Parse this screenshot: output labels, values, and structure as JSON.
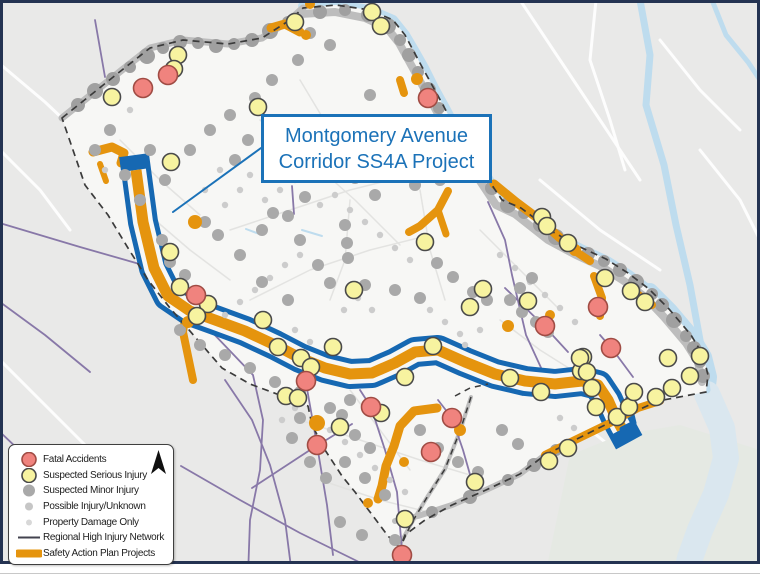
{
  "callout": {
    "line1": "Montgomery Avenue",
    "line2": "Corridor SS4A Project"
  },
  "legend": {
    "items": [
      {
        "label": "Fatal Accidents",
        "type": "circle",
        "fill": "#f0837e",
        "stroke": "#a04c44",
        "r": 7
      },
      {
        "label": "Suspected Serious Injury",
        "type": "circle",
        "fill": "#f7f3a0",
        "stroke": "#4a4a4a",
        "r": 7
      },
      {
        "label": "Suspected Minor Injury",
        "type": "circle",
        "fill": "#a9a9a9",
        "stroke": "none",
        "r": 6
      },
      {
        "label": "Possible Injury/Unknown",
        "type": "circle",
        "fill": "#c6c6c6",
        "stroke": "none",
        "r": 4
      },
      {
        "label": "Property Damage Only",
        "type": "circle",
        "fill": "#d8d8d8",
        "stroke": "none",
        "r": 3
      },
      {
        "label": "Regional High Injury Network",
        "type": "line",
        "stroke": "#43434f",
        "w": 2
      },
      {
        "label": "Safety Action Plan Projects",
        "type": "thick-line",
        "stroke": "#e5940e",
        "w": 8
      }
    ]
  },
  "colors": {
    "outer_border": "#243352",
    "bg_outside": "#e9e9e8",
    "bg_inside": "#f7f7f5",
    "river": "#bedcee",
    "river_mouth": "#dae7ef",
    "park": "#e5e9e3",
    "white_street": "#fdfdfd",
    "inner_street": "#e3e3e1",
    "gray_band": "#bdbdbd",
    "band_dot": "#a0a0a0",
    "gray_dot": "#a9a9a9",
    "small_dot": "#cccccc",
    "purple": "#8878a8",
    "orange": "#e5940e",
    "corridor_blue": "#1668b2",
    "boundary": "#3b3b3b",
    "callout_blue": "#1b72b8",
    "yellow_fill": "#f7f3a0",
    "yellow_stroke": "#4a4a4a",
    "red_fill": "#f0837e",
    "red_stroke": "#a04c44",
    "bottom_line": "#c8c8c8"
  },
  "map": {
    "study_area_path": "M62,118 L92,94 L122,70 L150,48 L183,40 L228,44 L262,38 L290,20 L303,8 L336,5 L370,10 L393,20 L405,35 L413,50 L421,65 L432,85 L443,105 L452,122 L462,140 L472,158 L483,172 L502,200 L521,208 L553,232 L580,247 L606,259 L628,273 L649,289 L669,309 L691,335 L703,355 L708,375 L706,392 L658,401 L605,425 L575,440 L545,455 L520,474 L486,490 L452,505 L425,520 L405,535 L400,548 L388,536 L370,512 L355,492 L342,476 L325,450 L312,425 L308,406 L285,397 L250,384 L222,368 L196,338 L170,308 L148,280 L128,248 L108,215 L85,185 Z",
    "boundary_extra": [
      "M471,397 L460,431 L445,469 L426,499 L411,524 L400,548",
      "M455,396 L470,388 L488,384"
    ],
    "park_path": "M570,455 L620,435 L680,425 L760,450 L760,576 L545,576 Z",
    "rivers": [
      {
        "d": "M303,6 L336,5 L370,10 L393,20 L405,35 L415,52 L424,68 L434,88 L445,108 L454,125 L464,143 L474,160 L485,174 L503,201 L522,210 L553,234 L581,249 L607,261 L629,275 L650,291 L670,311 L692,337 L704,357 L709,377 L707,394",
        "w": 10,
        "c": "river"
      },
      {
        "d": "M650,291 L670,311 L692,337 L704,357 L709,377 L707,394",
        "w": 16,
        "c": "river"
      },
      {
        "d": "M707,394 L722,428 L726,458 L716,494 L700,530 L690,558 L686,576",
        "w": 26,
        "c": "river_mouth"
      },
      {
        "d": "M640,0 L650,55 L646,105 L664,165 L676,225 L690,285 L700,340 L707,390",
        "w": 7,
        "c": "river"
      },
      {
        "d": "M712,0 L726,35 L748,62 L760,80",
        "w": 5,
        "c": "river"
      }
    ],
    "white_streets": [
      "M520,0 L560,60 L600,120 L640,180",
      "M596,0 L590,60 L610,120 L625,170",
      "M660,40 L700,90 L740,130",
      "M540,180 L600,230 L660,270",
      "M700,150 L740,200 L760,240",
      "M0,64 L45,102 L80,135",
      "M0,150 L40,190 L70,230",
      "M0,360 L60,420 L110,470",
      "M30,576 L80,520 L140,470",
      "M600,460 L650,500 L700,540",
      "M620,576 L660,520 L700,480",
      "M590,430 L640,470"
    ],
    "inner_streets": [
      "M260,120 L310,160 L355,200 L400,245",
      "M230,230 L290,210 L350,190 L410,175",
      "M250,300 L310,270 L370,250 L430,235",
      "M350,200 L345,260 L330,300",
      "M420,190 L430,250 L445,300",
      "M300,80 L330,130 L355,175",
      "M480,230 L520,270 L560,310",
      "M300,420 L360,440 L420,460 L480,478",
      "M320,480 L380,500 L440,515",
      "M350,390 L380,430 L410,470",
      "M500,320 L540,350 L575,372",
      "M155,220 L190,250 L230,280",
      "M120,140 L160,180 L200,215"
    ],
    "creeks": [
      "M302,230 L322,236",
      "M246,229 L262,235",
      "M352,120 L368,128"
    ],
    "gray_bands": [
      {
        "d": "M62,118 L92,94 L122,70 L150,48 L183,40 L228,44 L262,38 L290,20 L303,8",
        "w": 7
      },
      {
        "d": "M300,14 L335,12 L365,18 L387,28 L399,43 L415,72 L437,112 L456,145 L468,164 L478,178 L496,205 L515,214 L548,240 L576,255 L602,267 L624,281 L645,297 L664,317 L686,343 L698,362 L702,382",
        "w": 8
      },
      {
        "d": "M545,455 L520,474 L488,489 L452,505 L418,516 L395,521",
        "w": 6
      },
      {
        "d": "M471,397 L460,431 L445,469 L426,499 L411,524 L400,544",
        "w": 4
      }
    ],
    "purple_roads": [
      "M95,20 L105,77",
      "M292,186 L294,214",
      "M3,224 L80,247 L150,267 L210,330 L253,375 L263,420 L260,470 L250,520 L248,576",
      "M181,466 L240,500 L300,533 L359,562",
      "M225,380 L252,420 L270,465 L285,520 L292,575",
      "M252,488 L310,450 L352,424",
      "M488,202 L505,240 L512,275 L526,335 L543,372",
      "M505,288 L545,327 L568,352",
      "M600,335 L613,350 L633,377",
      "M306,383 L317,445 L327,505 L333,555",
      "M360,390 L371,407 L385,450 L397,492 L402,550",
      "M438,400 L452,418 L463,450 L471,478",
      "M0,432 L40,470 L85,520 L120,560 L135,576",
      "M0,302 L45,335 L90,372"
    ],
    "orange_paths": [
      {
        "d": "M93,152 L112,147 L124,153 L121,163",
        "w": 9
      },
      {
        "d": "M100,164 L106,181",
        "w": 6
      },
      {
        "d": "M271,28 L285,24 L300,32",
        "w": 9
      },
      {
        "d": "M400,80 L404,93",
        "w": 8
      },
      {
        "d": "M448,191 L438,210 L420,226 L409,232",
        "w": 8
      },
      {
        "d": "M438,210 L446,234",
        "w": 7
      },
      {
        "d": "M494,184 L516,202 L540,220 L560,238",
        "w": 9
      },
      {
        "d": "M572,249 L590,261",
        "w": 8
      },
      {
        "d": "M594,276 L602,298 L600,316",
        "w": 8
      },
      {
        "d": "M628,287 L652,305",
        "w": 8
      },
      {
        "d": "M186,312 L183,332 L188,356 L193,380",
        "w": 8
      },
      {
        "d": "M437,408 L414,411 L400,426 L394,446 L386,466 L382,486 L378,499",
        "w": 9
      },
      {
        "d": "M548,377 L572,383",
        "w": 7
      }
    ],
    "orange_after": [
      {
        "d": "M545,455 L575,440 L608,424 L638,408 L660,401",
        "w": 8
      }
    ],
    "orange_blobs": [
      [
        417,
        79,
        6
      ],
      [
        310,
        4,
        5
      ],
      [
        195,
        222,
        7
      ],
      [
        188,
        322,
        6
      ],
      [
        317,
        423,
        8
      ],
      [
        404,
        462,
        5
      ],
      [
        368,
        503,
        5
      ],
      [
        508,
        326,
        6
      ],
      [
        550,
        315,
        5
      ],
      [
        460,
        430,
        6
      ],
      [
        306,
        35,
        5
      ],
      [
        575,
        250,
        6
      ]
    ],
    "corridor": {
      "centerline": "M136,170 L143,222 L154,268 L168,296 L190,311 L215,320 L245,331 L275,345 L300,358 L325,368 L350,374 L372,373 L395,363 L415,352 L438,350 L465,362 L495,374 L525,381 L555,384 L582,381 L598,385 L608,400 L616,418 L622,429",
      "tail": "M622,429 L634,423 L628,398",
      "blue_w": 30,
      "hollow_w": 20,
      "orange_w": 11,
      "tail_w": 5
    },
    "band_dots": [
      [
        78,
        105,
        7
      ],
      [
        95,
        91,
        8
      ],
      [
        113,
        79,
        7
      ],
      [
        130,
        67,
        6
      ],
      [
        147,
        56,
        8
      ],
      [
        163,
        48,
        6
      ],
      [
        180,
        42,
        7
      ],
      [
        198,
        43,
        6
      ],
      [
        216,
        46,
        7
      ],
      [
        234,
        44,
        6
      ],
      [
        252,
        40,
        7
      ],
      [
        270,
        31,
        8
      ],
      [
        288,
        22,
        6
      ],
      [
        320,
        12,
        7
      ],
      [
        345,
        10,
        6
      ],
      [
        368,
        15,
        7
      ],
      [
        388,
        26,
        8
      ],
      [
        400,
        40,
        6
      ],
      [
        409,
        55,
        7
      ],
      [
        418,
        72,
        6
      ],
      [
        428,
        90,
        8
      ],
      [
        439,
        108,
        6
      ],
      [
        449,
        124,
        7
      ],
      [
        459,
        142,
        6
      ],
      [
        469,
        159,
        7
      ],
      [
        480,
        173,
        6
      ],
      [
        492,
        188,
        7
      ],
      [
        508,
        205,
        8
      ],
      [
        524,
        213,
        6
      ],
      [
        540,
        225,
        7
      ],
      [
        556,
        237,
        8
      ],
      [
        572,
        247,
        6
      ],
      [
        588,
        254,
        7
      ],
      [
        604,
        261,
        6
      ],
      [
        620,
        270,
        7
      ],
      [
        636,
        282,
        8
      ],
      [
        652,
        294,
        6
      ],
      [
        662,
        305,
        7
      ],
      [
        674,
        320,
        8
      ],
      [
        686,
        336,
        6
      ],
      [
        694,
        348,
        7
      ],
      [
        700,
        362,
        6
      ],
      [
        703,
        376,
        7
      ],
      [
        556,
        450,
        6
      ],
      [
        534,
        465,
        7
      ],
      [
        508,
        480,
        6
      ],
      [
        470,
        497,
        7
      ],
      [
        432,
        512,
        6
      ],
      [
        408,
        518,
        5
      ]
    ],
    "gray_dots": [
      [
        273,
        213
      ],
      [
        288,
        216
      ],
      [
        305,
        197
      ],
      [
        375,
        195
      ],
      [
        345,
        225
      ],
      [
        347,
        243
      ],
      [
        348,
        258
      ],
      [
        330,
        283
      ],
      [
        365,
        285
      ],
      [
        395,
        290
      ],
      [
        420,
        298
      ],
      [
        427,
        245
      ],
      [
        437,
        263
      ],
      [
        453,
        277
      ],
      [
        473,
        292
      ],
      [
        487,
        300
      ],
      [
        300,
        240
      ],
      [
        262,
        230
      ],
      [
        318,
        265
      ],
      [
        288,
        300
      ],
      [
        262,
        282
      ],
      [
        240,
        255
      ],
      [
        218,
        235
      ],
      [
        205,
        222
      ],
      [
        510,
        300
      ],
      [
        522,
        312
      ],
      [
        536,
        322
      ],
      [
        548,
        332
      ],
      [
        520,
        288
      ],
      [
        532,
        278
      ],
      [
        350,
        400
      ],
      [
        342,
        415
      ],
      [
        355,
        435
      ],
      [
        370,
        448
      ],
      [
        330,
        408
      ],
      [
        300,
        418
      ],
      [
        292,
        438
      ],
      [
        310,
        462
      ],
      [
        326,
        478
      ],
      [
        345,
        462
      ],
      [
        365,
        478
      ],
      [
        385,
        495
      ],
      [
        420,
        430
      ],
      [
        438,
        448
      ],
      [
        458,
        462
      ],
      [
        478,
        472
      ],
      [
        340,
        522
      ],
      [
        362,
        535
      ],
      [
        502,
        430
      ],
      [
        518,
        444
      ],
      [
        310,
        33
      ],
      [
        330,
        45
      ],
      [
        298,
        60
      ],
      [
        272,
        80
      ],
      [
        255,
        98
      ],
      [
        285,
        120
      ],
      [
        310,
        140
      ],
      [
        335,
        160
      ],
      [
        355,
        178
      ],
      [
        248,
        140
      ],
      [
        235,
        160
      ],
      [
        380,
        120
      ],
      [
        395,
        140
      ],
      [
        370,
        95
      ],
      [
        400,
        165
      ],
      [
        415,
        185
      ],
      [
        440,
        180
      ],
      [
        150,
        150
      ],
      [
        165,
        180
      ],
      [
        140,
        200
      ],
      [
        125,
        175
      ],
      [
        190,
        150
      ],
      [
        210,
        130
      ],
      [
        230,
        115
      ],
      [
        110,
        130
      ],
      [
        95,
        150
      ],
      [
        180,
        330
      ],
      [
        200,
        345
      ],
      [
        225,
        355
      ],
      [
        250,
        368
      ],
      [
        275,
        382
      ],
      [
        300,
        392
      ],
      [
        162,
        240
      ],
      [
        170,
        262
      ],
      [
        185,
        275
      ],
      [
        395,
        540
      ]
    ],
    "small_dots": [
      [
        265,
        200
      ],
      [
        280,
        190
      ],
      [
        295,
        180
      ],
      [
        310,
        170
      ],
      [
        250,
        175
      ],
      [
        240,
        190
      ],
      [
        225,
        205
      ],
      [
        320,
        205
      ],
      [
        335,
        195
      ],
      [
        350,
        210
      ],
      [
        365,
        222
      ],
      [
        380,
        235
      ],
      [
        395,
        248
      ],
      [
        410,
        260
      ],
      [
        300,
        255
      ],
      [
        285,
        265
      ],
      [
        270,
        278
      ],
      [
        255,
        290
      ],
      [
        240,
        302
      ],
      [
        225,
        315
      ],
      [
        430,
        310
      ],
      [
        445,
        322
      ],
      [
        460,
        334
      ],
      [
        295,
        330
      ],
      [
        310,
        342
      ],
      [
        500,
        255
      ],
      [
        515,
        268
      ],
      [
        530,
        282
      ],
      [
        545,
        295
      ],
      [
        560,
        308
      ],
      [
        575,
        322
      ],
      [
        480,
        330
      ],
      [
        465,
        345
      ],
      [
        372,
        310
      ],
      [
        358,
        298
      ],
      [
        344,
        310
      ],
      [
        330,
        430
      ],
      [
        345,
        442
      ],
      [
        360,
        455
      ],
      [
        375,
        468
      ],
      [
        390,
        480
      ],
      [
        405,
        492
      ],
      [
        295,
        408
      ],
      [
        282,
        420
      ],
      [
        560,
        418
      ],
      [
        574,
        428
      ],
      [
        205,
        190
      ],
      [
        220,
        170
      ],
      [
        130,
        110
      ],
      [
        105,
        170
      ]
    ],
    "yellow_dots": [
      [
        178,
        55
      ],
      [
        174,
        69
      ],
      [
        112,
        97
      ],
      [
        171,
        162
      ],
      [
        295,
        22
      ],
      [
        372,
        12
      ],
      [
        381,
        26
      ],
      [
        258,
        107
      ],
      [
        542,
        217
      ],
      [
        547,
        226
      ],
      [
        568,
        243
      ],
      [
        605,
        278
      ],
      [
        631,
        291
      ],
      [
        645,
        302
      ],
      [
        528,
        301
      ],
      [
        583,
        357
      ],
      [
        668,
        358
      ],
      [
        690,
        376
      ],
      [
        700,
        356
      ],
      [
        581,
        371
      ],
      [
        170,
        252
      ],
      [
        180,
        287
      ],
      [
        208,
        304
      ],
      [
        197,
        316
      ],
      [
        263,
        320
      ],
      [
        278,
        347
      ],
      [
        301,
        358
      ],
      [
        311,
        367
      ],
      [
        333,
        347
      ],
      [
        354,
        290
      ],
      [
        425,
        242
      ],
      [
        470,
        307
      ],
      [
        483,
        289
      ],
      [
        433,
        346
      ],
      [
        405,
        377
      ],
      [
        510,
        378
      ],
      [
        541,
        392
      ],
      [
        580,
        358
      ],
      [
        587,
        372
      ],
      [
        592,
        388
      ],
      [
        596,
        407
      ],
      [
        617,
        417
      ],
      [
        629,
        407
      ],
      [
        634,
        392
      ],
      [
        656,
        397
      ],
      [
        672,
        388
      ],
      [
        286,
        396
      ],
      [
        298,
        398
      ],
      [
        340,
        427
      ],
      [
        381,
        413
      ],
      [
        475,
        482
      ],
      [
        405,
        519
      ],
      [
        568,
        448
      ],
      [
        549,
        461
      ]
    ],
    "red_dots": [
      [
        143,
        88
      ],
      [
        168,
        75
      ],
      [
        428,
        98
      ],
      [
        196,
        295
      ],
      [
        306,
        381
      ],
      [
        371,
        407
      ],
      [
        452,
        418
      ],
      [
        431,
        452
      ],
      [
        317,
        445
      ],
      [
        402,
        555
      ],
      [
        598,
        307
      ],
      [
        545,
        326
      ],
      [
        611,
        348
      ]
    ],
    "leader": "M261,148 L173,212"
  }
}
